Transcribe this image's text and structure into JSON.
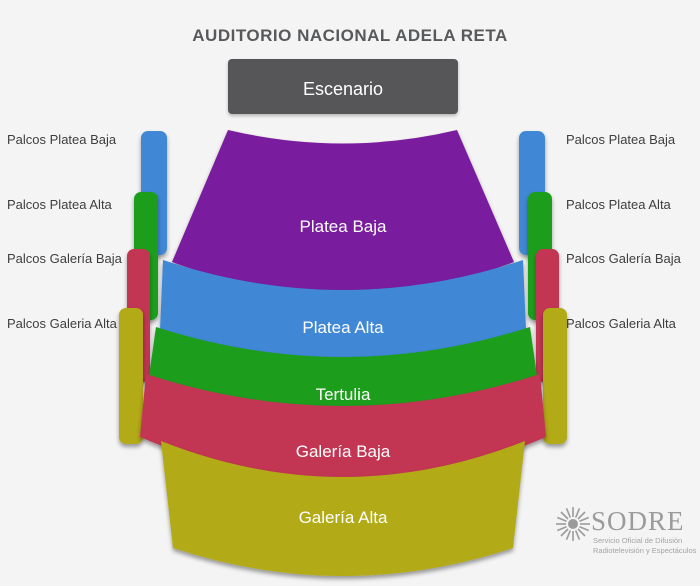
{
  "title": "AUDITORIO NACIONAL ADELA RETA",
  "stage": {
    "label": "Escenario",
    "color": "#565759"
  },
  "sections": [
    {
      "name": "Platea Baja",
      "color": "#7a1f9e"
    },
    {
      "name": "Platea Alta",
      "color": "#4187d6"
    },
    {
      "name": "Tertulia",
      "color": "#1f9e1f"
    },
    {
      "name": "Galería Baja",
      "color": "#c23453"
    },
    {
      "name": "Galería Alta",
      "color": "#b2aa16"
    }
  ],
  "palcos": {
    "colors": [
      "#4187d6",
      "#1f9e1f",
      "#c23453",
      "#b2aa16"
    ],
    "left": [
      "Palcos Platea Baja",
      "Palcos Platea Alta",
      "Palcos Galería Baja",
      "Palcos Galeria Alta"
    ],
    "right": [
      "Palcos Platea Baja",
      "Palcos Platea Alta",
      "Palcos Galería Baja",
      "Palcos Galeria Alta"
    ]
  },
  "logo": {
    "name": "SODRE",
    "tagline1": "Servicio Oficial de Difusión",
    "tagline2": "Radiotelevisión y Espectáculos"
  },
  "background": "#f4f4f4"
}
